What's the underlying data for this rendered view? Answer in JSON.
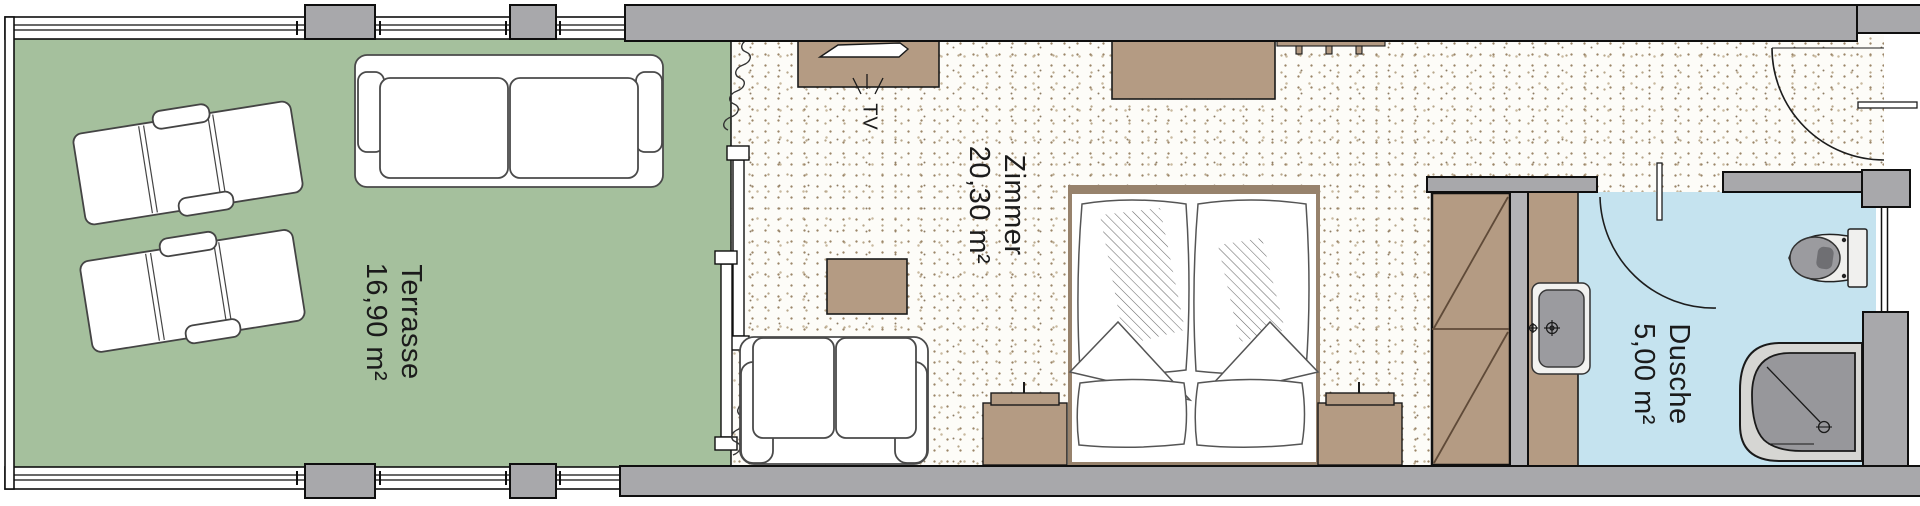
{
  "plan": {
    "title": "Hotel room floor plan",
    "rooms": [
      {
        "name": "Terrasse",
        "area": "16,90 m²"
      },
      {
        "name": "Zimmer",
        "area": "20,30 m²"
      },
      {
        "name": "Dusche",
        "area": "5,00 m²"
      }
    ],
    "labels": {
      "tv": "TV"
    },
    "colors": {
      "terrace_floor": "#a5c09d",
      "room_floor_base": "#fdfcf8",
      "room_floor_speckle": "#9c8668",
      "bath_floor": "#c5e3ef",
      "furniture_wood": "#b49b83",
      "wall_grey": "#a8a8ab",
      "partition_grey": "#b3b3b6",
      "fixture_grey": "#97979b",
      "outline": "#111111"
    },
    "icons": [
      "lounge-chair-icon",
      "sofa-icon",
      "tv-icon",
      "coffee-table-icon",
      "double-bed-icon",
      "nightstand-icon",
      "wardrobe-icon",
      "coat-rack-icon",
      "sink-icon",
      "toilet-icon",
      "shower-icon",
      "door-swing-icon",
      "sliding-door-icon",
      "curtain-icon",
      "window-icon"
    ]
  }
}
